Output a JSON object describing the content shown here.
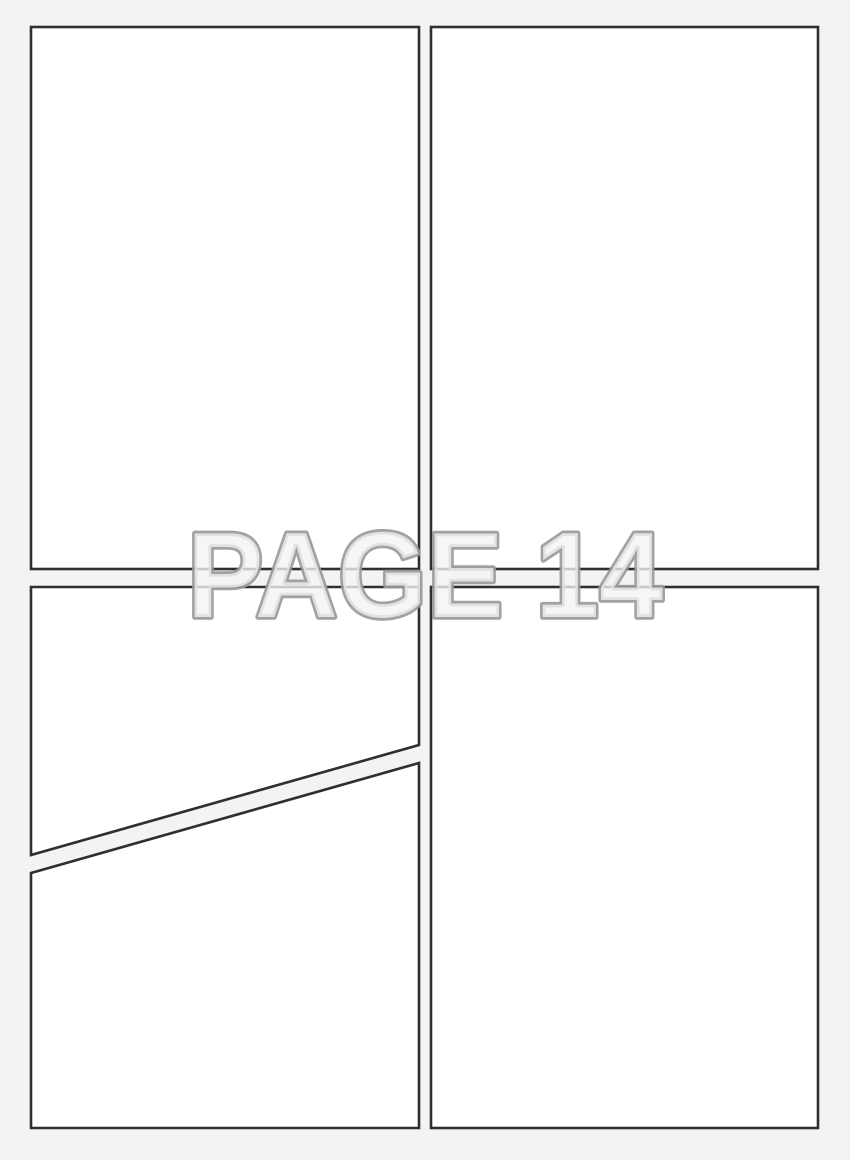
{
  "page_label": {
    "text": "PAGE 14"
  },
  "panels": {
    "count": 5,
    "names": [
      "top-left",
      "top-right",
      "bottom-left-upper",
      "bottom-left-lower",
      "bottom-right"
    ]
  },
  "colors": {
    "background": "#f3f3f4",
    "panel_fill": "#ffffff",
    "panel_border": "#2f2f2f",
    "label_outline": "#9a9a9a",
    "label_fill": "#f3f3f4"
  }
}
